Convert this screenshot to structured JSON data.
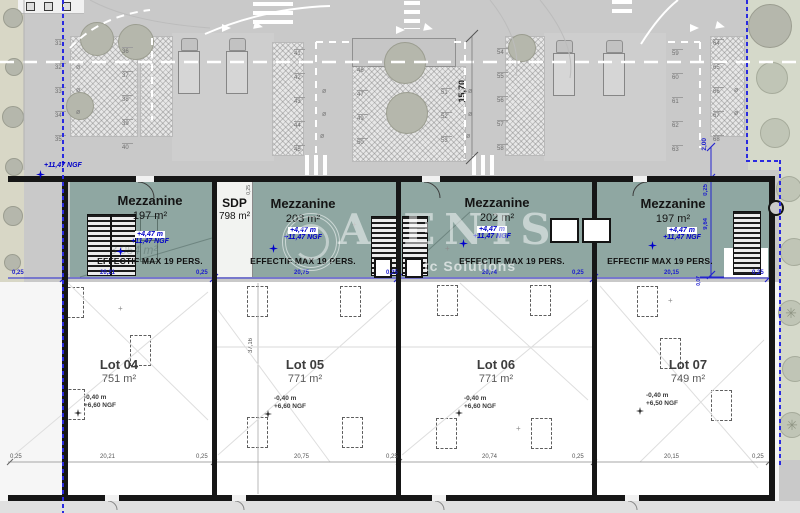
{
  "watermark": {
    "main": "A ENIS",
    "sub": "tc Solutions"
  },
  "street_ngf": "+11,47 NGF",
  "mezzanines": [
    {
      "title": "Mezzanine",
      "area": "197 m²",
      "level": "+4,47 m",
      "ngf": "+11,47 NGF",
      "max_occupancy": "EFFECTIF MAX 19 PERS.",
      "ghost": "3 054 m²"
    },
    {
      "sdp": {
        "label": "SDP",
        "area": "798 m²"
      },
      "title": "Mezzanine",
      "area": "203 m²",
      "level": "+4,47 m",
      "ngf": "+11,47 NGF",
      "max_occupancy": "EFFECTIF MAX 19 PERS."
    },
    {
      "title": "Mezzanine",
      "area": "202 m²",
      "level": "+4,47 m",
      "ngf": "+11,47 NGF",
      "max_occupancy": "EFFECTIF MAX 19 PERS."
    },
    {
      "title": "Mezzanine",
      "area": "197 m²",
      "level": "+4,47 m",
      "ngf": "+11,47 NGF",
      "max_occupancy": "EFFECTIF MAX 19 PERS."
    }
  ],
  "lots": [
    {
      "name": "Lot 04",
      "area": "751 m²",
      "level": "-0,40 m",
      "ngf": "+6,60 NGF"
    },
    {
      "name": "Lot 05",
      "area": "771 m²",
      "level": "-0,40 m",
      "ngf": "+6,60 NGF"
    },
    {
      "name": "Lot 06",
      "area": "771 m²",
      "level": "-0,40 m",
      "ngf": "+6,60 NGF"
    },
    {
      "name": "Lot 07",
      "area": "749 m²",
      "level": "-0,40 m",
      "ngf": "+6,50 NGF"
    }
  ],
  "dims": {
    "top": [
      "0,25",
      "20,21",
      "0,25",
      "20,75",
      "0,25",
      "20,74",
      "0,25",
      "20,15",
      "0,25"
    ],
    "bottom": [
      "0,25",
      "20,21",
      "0,25",
      "20,75",
      "0,25",
      "20,74",
      "0,25",
      "20,15",
      "0,25"
    ],
    "right": {
      "offset": "2,00",
      "wall": "0,25",
      "depth": "9,64",
      "small": "0,07"
    },
    "sdp_strip": "0,25",
    "lot_depth": "37,16",
    "road_width": "15,70"
  },
  "parking": {
    "col1": [
      "31",
      "32",
      "33",
      "34",
      "35"
    ],
    "col2": [
      "36",
      "37",
      "38",
      "39",
      "40"
    ],
    "col3": [
      "41",
      "42",
      "43",
      "44",
      "45"
    ],
    "island_left": [
      "46",
      "47",
      "49",
      "50"
    ],
    "island_right": [
      "51",
      "52",
      "53"
    ],
    "col4": [
      "54",
      "55",
      "56",
      "57",
      "58"
    ],
    "col5": [
      "59",
      "60",
      "61",
      "62",
      "63"
    ],
    "col6": [
      "64",
      "65",
      "66",
      "67",
      "68"
    ]
  },
  "colors": {
    "mezzanine_fill": "#8fa7a2",
    "dimension_blue": "#1d1dcf",
    "level_blue": "#0000c8",
    "wall": "#161616",
    "road": "#c9c9c9"
  }
}
